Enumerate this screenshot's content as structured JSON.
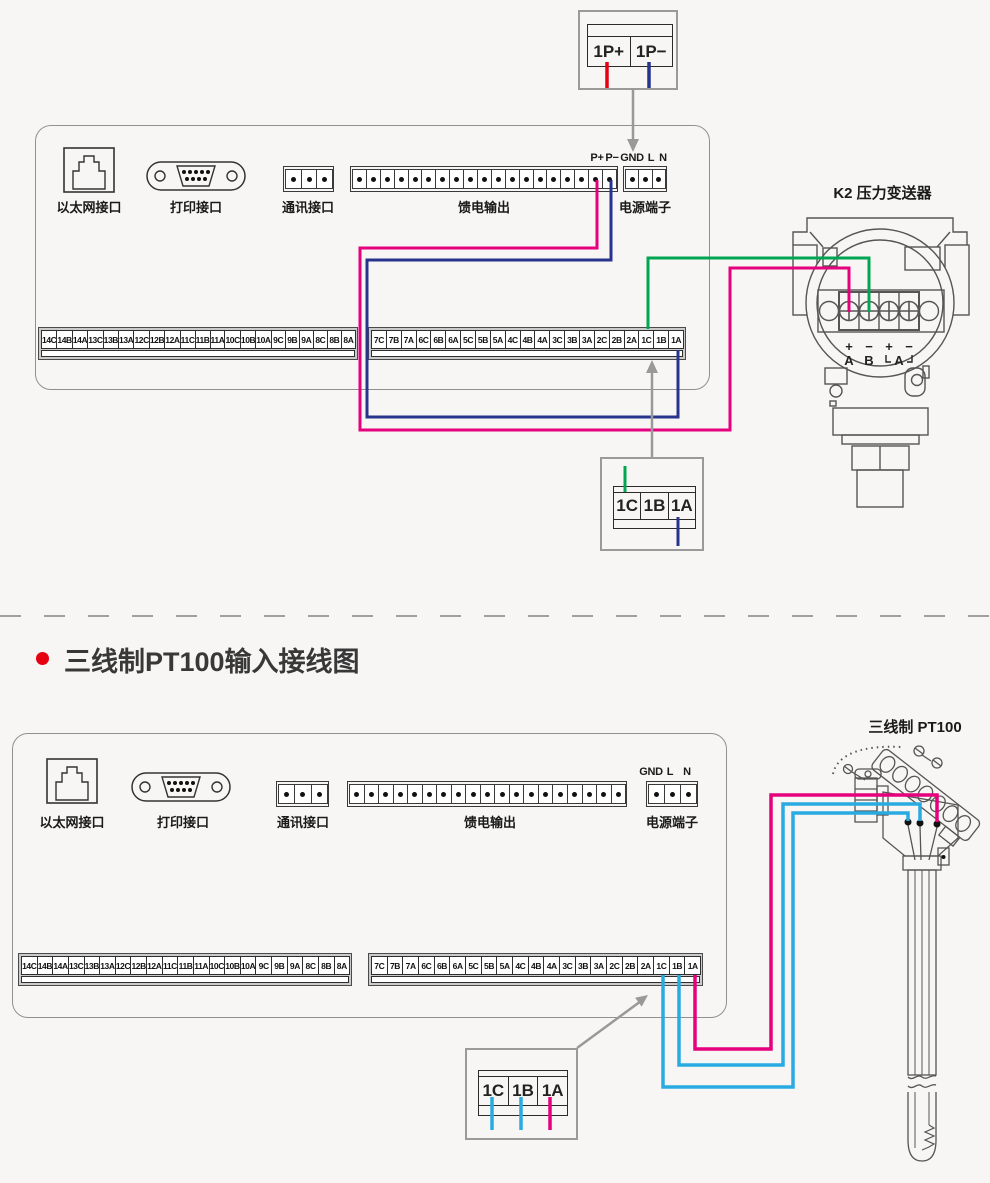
{
  "colors": {
    "magenta": "#e6007e",
    "navy": "#27348b",
    "red": "#e60012",
    "green": "#00a651",
    "cyan": "#29abe2",
    "gray": "#999999",
    "bullet_red": "#e60012"
  },
  "section_title": "三线制PT100输入接线图",
  "panel": {
    "ethernet_label": "以太网接口",
    "printer_label": "打印接口",
    "comm_label": "通讯接口",
    "feed_label": "馈电输出",
    "power_label": "电源端子",
    "strip_left": [
      "14C",
      "14B",
      "14A",
      "13C",
      "13B",
      "13A",
      "12C",
      "12B",
      "12A",
      "11C",
      "11B",
      "11A",
      "10C",
      "10B",
      "10A",
      "9C",
      "9B",
      "9A",
      "8C",
      "8B",
      "8A"
    ],
    "strip_right": [
      "7C",
      "7B",
      "7A",
      "6C",
      "6B",
      "6A",
      "5C",
      "5B",
      "5A",
      "4C",
      "4B",
      "4A",
      "3C",
      "3B",
      "3A",
      "2C",
      "2B",
      "2A",
      "1C",
      "1B",
      "1A"
    ]
  },
  "top_diagram": {
    "loop_box": {
      "cells": [
        "1P+",
        "1P−"
      ]
    },
    "p_plus": "P+",
    "p_minus": "P−",
    "gnd": "GND",
    "line": "L",
    "neutral": "N",
    "input_box": {
      "cells": [
        "1C",
        "1B",
        "1A"
      ]
    },
    "transmitter": {
      "title": "K2  压力变送器",
      "sign1": "+",
      "sign2": "−",
      "sign3": "+",
      "sign4": "−",
      "letter_a": "A",
      "letter_b": "B",
      "letter_a2": "A"
    }
  },
  "bottom_diagram": {
    "gnd": "GND",
    "line": "L",
    "neutral": "N",
    "input_box": {
      "cells": [
        "1C",
        "1B",
        "1A"
      ]
    },
    "sensor_title": "三线制  PT100"
  }
}
